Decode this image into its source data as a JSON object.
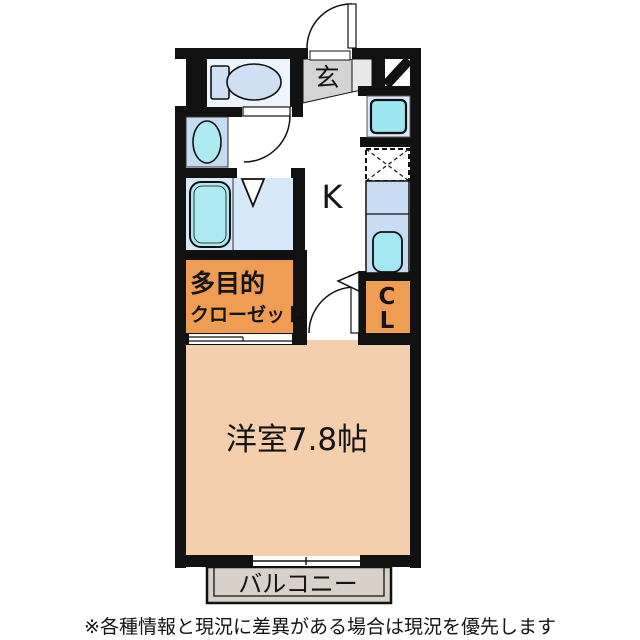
{
  "floorplan": {
    "rooms": {
      "entrance": {
        "label": "玄"
      },
      "kitchen": {
        "label": "K"
      },
      "multipurpose_closet": {
        "label_line1": "多目的",
        "label_line2": "クローゼット"
      },
      "closet": {
        "label_line1": "C",
        "label_line2": "L"
      },
      "western_room": {
        "label": "洋室7.8帖"
      },
      "balcony": {
        "label": "バルコニー"
      }
    },
    "colors": {
      "wall": "#111111",
      "western_room": "#f4cfad",
      "closet_orange": "#ee9d53",
      "entrance_gray": "#d4d4d4",
      "entrance_step": "#e8e8e8",
      "toilet_room": "#edf4fc",
      "bath_floor": "#d7e8f8",
      "fixture_blue": "#cfe0f4",
      "tub_cyan": "#aeeaf2",
      "basin_unit": "#c5dcf2",
      "counter": "#c8ddf4",
      "sink_cyan": "#a3e8f1",
      "washer_outer": "#dbeafc",
      "washer_inner": "#9de7f0",
      "balcony_gray": "#d9d1c9",
      "text": "#141414"
    }
  },
  "footer": {
    "disclaimer": "※各種情報と現況に差異がある場合は現況を優先します"
  }
}
